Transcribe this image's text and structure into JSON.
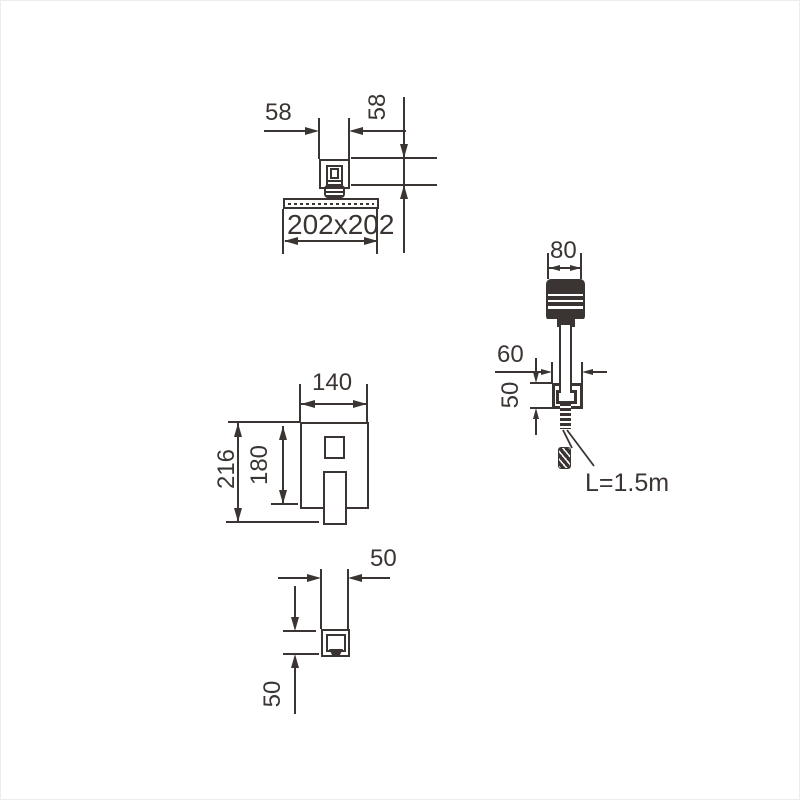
{
  "drawing": {
    "ink_color": "#3a3532",
    "background": "#ffffff",
    "views": {
      "overhead_shower": {
        "name": "overhead-shower-front-view",
        "arm_width": "58",
        "arm_height": "58",
        "face_size": "202x202"
      },
      "mixer": {
        "name": "mixer-trim-front-view",
        "plate_width": "140",
        "plate_height": "180",
        "total_height": "216"
      },
      "spout": {
        "name": "spout-bottom-view",
        "width": "50",
        "height": "50"
      },
      "hand_shower": {
        "name": "hand-shower-side-view",
        "head_width": "80",
        "bracket_width": "60",
        "bracket_height": "50",
        "hose_length": "L=1.5m"
      }
    }
  }
}
